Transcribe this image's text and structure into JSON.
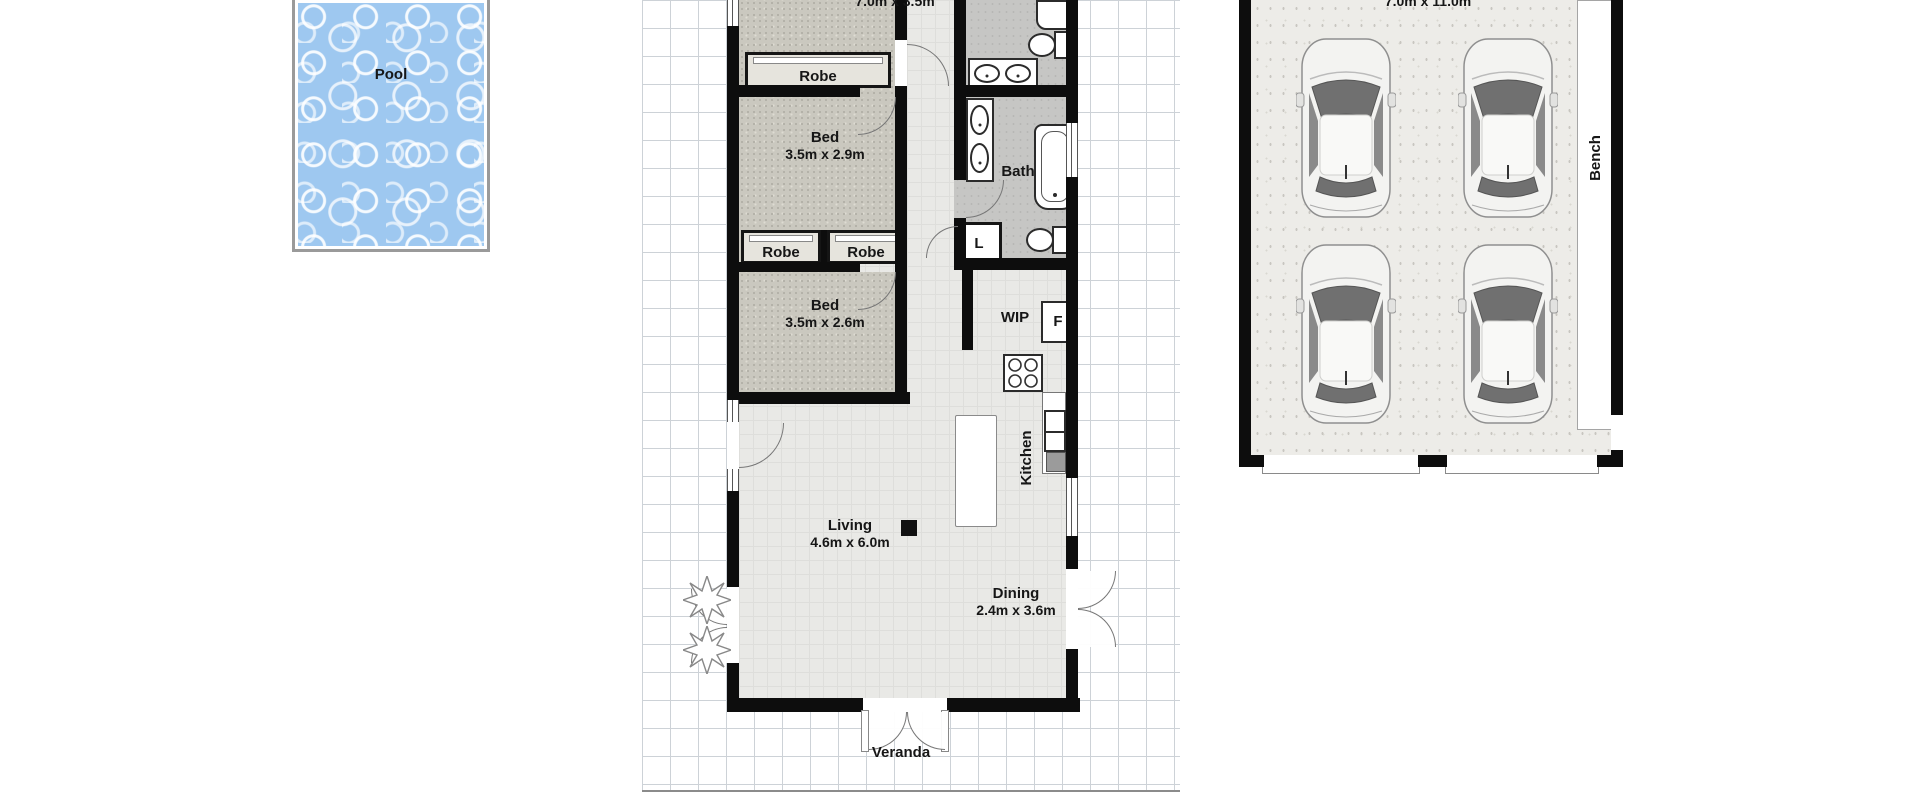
{
  "plan": {
    "pool": {
      "label": "Pool"
    },
    "house": {
      "master_bed_dims": "7.0m x 3.5m",
      "robe_master": "Robe",
      "bed1": {
        "label": "Bed",
        "dims": "3.5m x 2.9m"
      },
      "bath": "Bath",
      "robe_left": "Robe",
      "robe_right": "Robe",
      "laundry": "L",
      "bed2": {
        "label": "Bed",
        "dims": "3.5m x 2.6m"
      },
      "wip": "WIP",
      "fridge": "F",
      "kitchen": "Kitchen",
      "living": {
        "label": "Living",
        "dims": "4.6m x 6.0m"
      },
      "dining": {
        "label": "Dining",
        "dims": "2.4m x 3.6m"
      },
      "veranda": "Veranda"
    },
    "garage": {
      "dims": "7.0m x 11.0m",
      "bench": "Bench",
      "car_count": 4
    },
    "colors": {
      "water": "#9ec8f0",
      "wall": "#0d0d0d",
      "carpet": "#cac8bf",
      "wet_floor": "#c6c6c4",
      "main_floor": "#e9e9e6",
      "garage_floor": "#edece8",
      "grid_line": "#cdd2d7"
    }
  }
}
